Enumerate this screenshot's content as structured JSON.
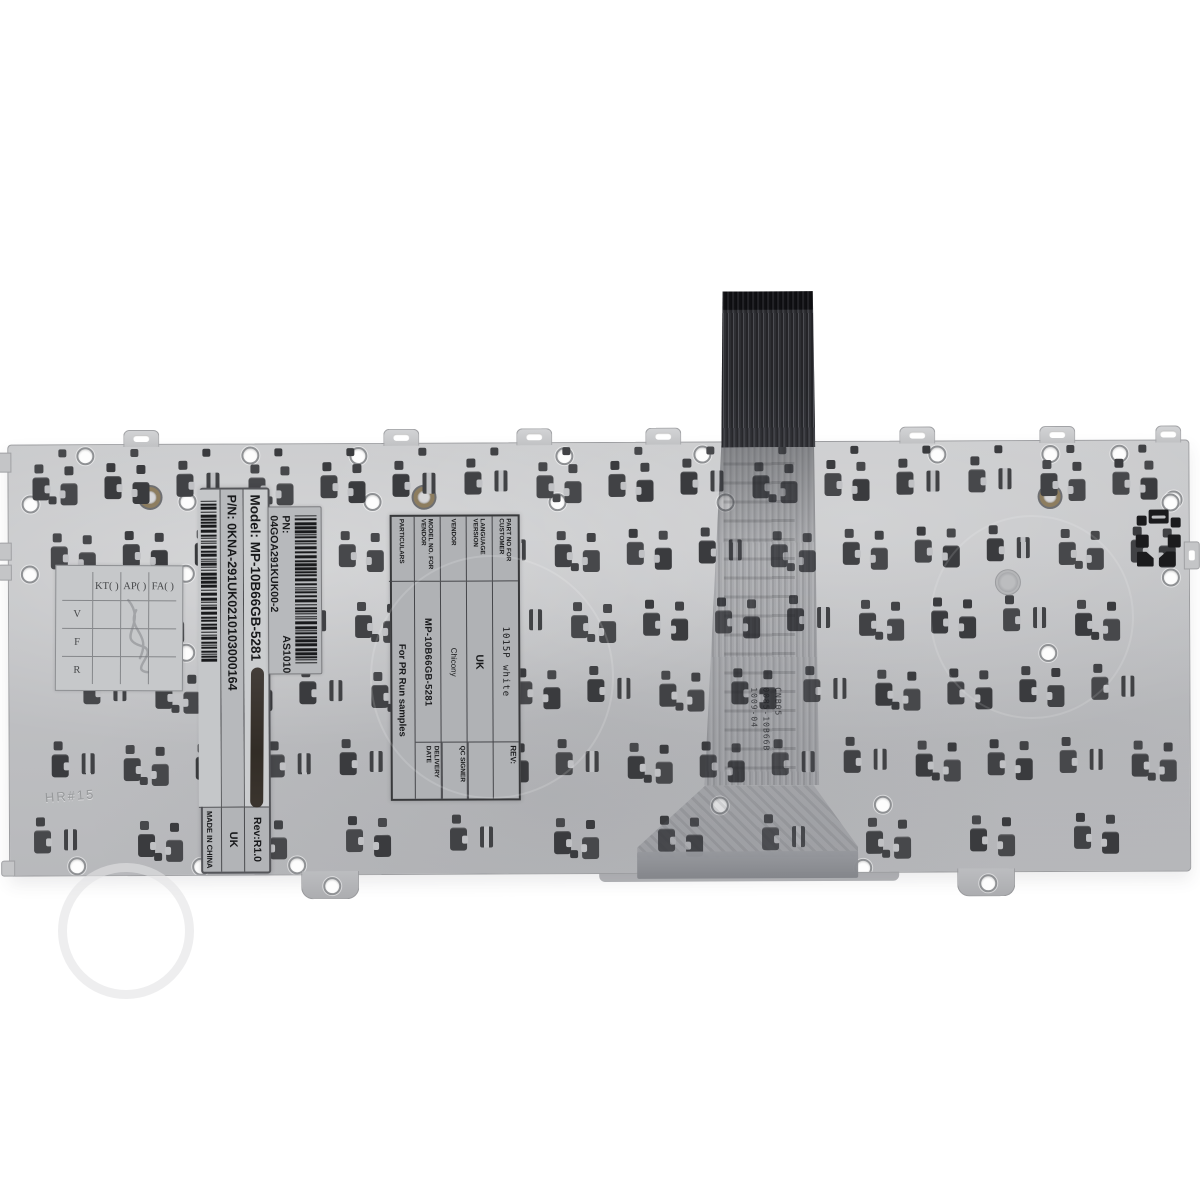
{
  "photo": {
    "subject": "Laptop keyboard rear metal backplate with ribbon cable and factory labels"
  },
  "stickers": {
    "model": {
      "line1": "Model: MP-10B66GB-5281",
      "line2": "P/N: 0KNA-291UK0210103000164",
      "rev": "Rev:R1.0",
      "lang": "UK",
      "origin": "MADE IN CHINA"
    },
    "vendor_pn": {
      "pn": "PN: 04GOA291KUK00-2",
      "batch": "AS1010"
    },
    "spec": {
      "rows": [
        {
          "label": "PART NO FOR CUSTOMER",
          "value": "1015P white"
        },
        {
          "label": "LANGUAGE VERSION",
          "value": "UK"
        },
        {
          "label": "VENDOR",
          "value": "Chicony"
        },
        {
          "label": "MODEL NO. FOR VENDOR",
          "value": "MP-10B66GB-5281"
        },
        {
          "label": "PARTICULARS",
          "value": "For PR Run samples"
        }
      ],
      "right": {
        "rev": "REV:",
        "qc": "QC SIGNER",
        "delivery": "DELIVERY DATE"
      }
    },
    "qc_grid": {
      "cols": [
        "KT( )",
        "AP( )",
        "FA( )"
      ],
      "rows": [
        "V",
        "F",
        "R"
      ]
    },
    "ribbon_print": {
      "line1": "CNB05",
      "line2": "0085-10B66B",
      "line3": "1009-04"
    },
    "plate_stamp": "HR#15"
  }
}
